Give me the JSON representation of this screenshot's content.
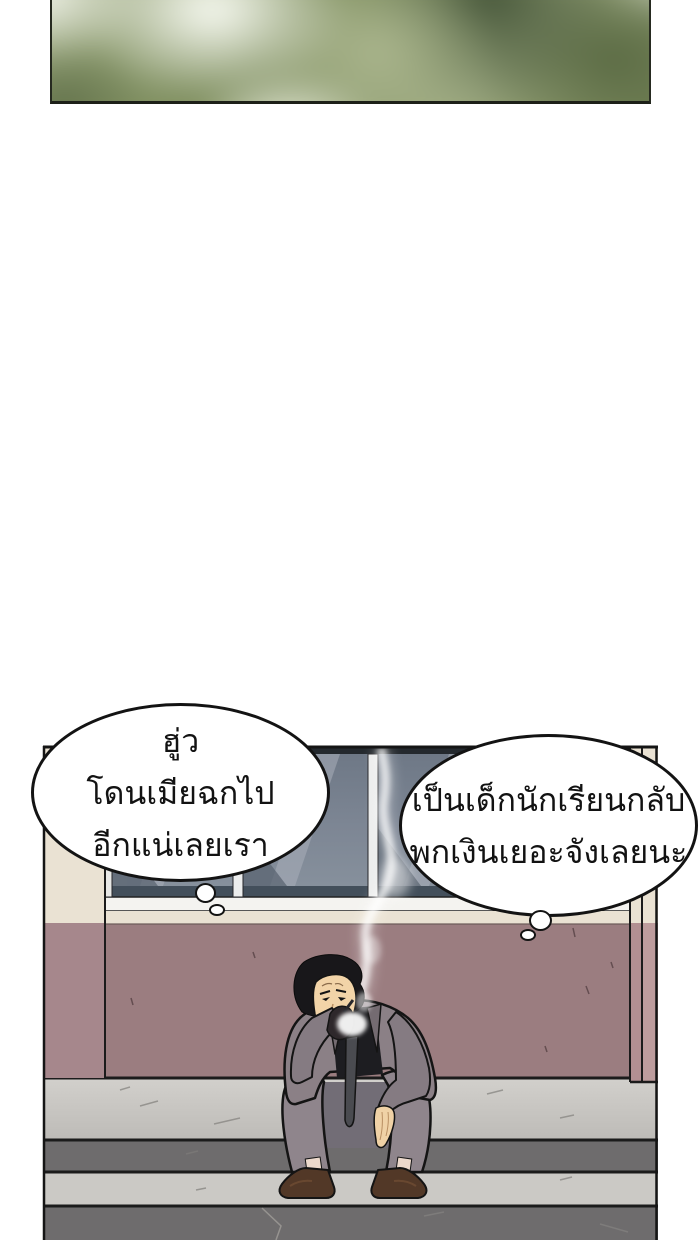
{
  "comic": {
    "thought_bubbles": {
      "left": {
        "line1": "ฮู่ว",
        "line2": "โดนเมียฉกไป",
        "line3": "อีกแน่เลยเรา"
      },
      "right": {
        "line1": "เป็นเด็กนักเรียนกลับ",
        "line2": "พกเงินเยอะจังเลยนะ"
      }
    },
    "colors": {
      "page_bg": "#ffffff",
      "panel_border": "#1b1b1b",
      "wall": "#9b7d80",
      "pillar_left": "#a6878c",
      "pillar_right": "#b58f92",
      "cream_band": "#eae2d3",
      "window_glass": "#7d8694",
      "window_sill": "#f4f3f0",
      "walkway": "#c7c5c1",
      "step_riser": "#6e6c6d",
      "step_tread": "#cbc9c5",
      "suit": "#8b8086",
      "shirt": "#1d1d21",
      "skin": "#f0d2a6",
      "hair": "#18171a",
      "shoes": "#523827",
      "smoke": "#ffffff",
      "bubble_fill": "#ffffff"
    }
  }
}
